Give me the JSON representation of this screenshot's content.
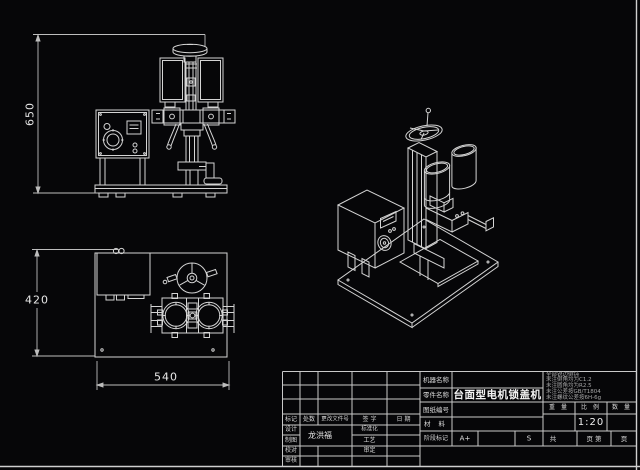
{
  "dimensions": {
    "front_height": "650",
    "plan_depth": "420",
    "plan_width": "540"
  },
  "title_block": {
    "revision_header": {
      "mark": "标记",
      "qty": "处数",
      "change_file_no": "更改文件号",
      "signature": "签 字",
      "date": "日 期"
    },
    "roles": {
      "design": "设计",
      "draft": "制图",
      "proof": "校对",
      "audit": "审核",
      "standardization": "标准化",
      "process": "工艺",
      "approval": "审定"
    },
    "designer_name": "龙洪福",
    "machine_name_label": "机器名称",
    "part_name_label": "零件名称",
    "part_name": "台面型电机锁盖机",
    "drawing_no_label": "图纸编号",
    "material_label": "材 料",
    "stage_label": "阶段标记",
    "stage_value_a": "A+",
    "stage_value_s": "S",
    "weight_label": "重 量",
    "scale_label": "比 例",
    "quantity_label": "数 量",
    "scale_value": "1:20",
    "sheet_total": "共",
    "sheet_mid": "页 第",
    "sheet_end": "页",
    "tech_notes": [
      "全部锐边倒钝",
      "未注倒角均为C1.2",
      "未注圆角均为R2.5",
      "未注公差按GB/T1804",
      "未注螺纹公差按6H-6g"
    ]
  }
}
